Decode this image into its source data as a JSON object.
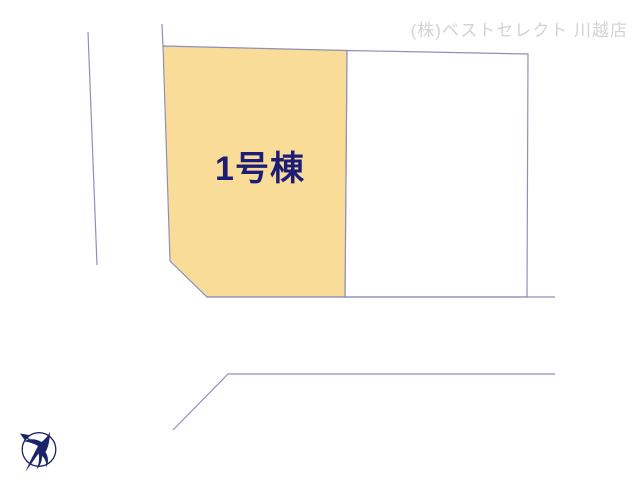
{
  "header": {
    "company_label": "(株)ベストセレクト 川越店"
  },
  "plan": {
    "lot1_label": "1号棟",
    "compass_icon": "north-arrow-bird-icon"
  },
  "colors": {
    "lot_fill": "#F9DC98",
    "line": "#908FBB",
    "lot_label": "#1D1D76",
    "header_text": "#D3D3D3",
    "compass": "#1B2468",
    "background": "#FFFFFF"
  }
}
